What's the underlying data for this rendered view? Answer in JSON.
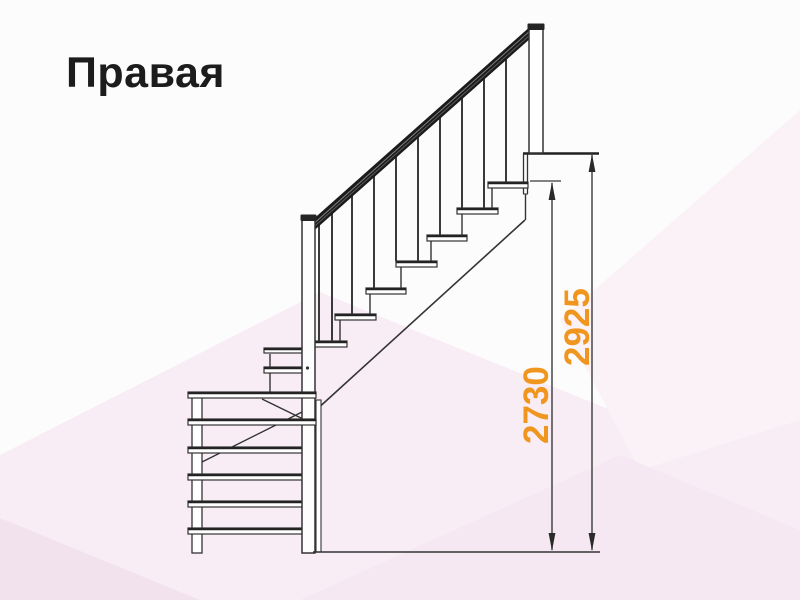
{
  "title": "Правая",
  "diagram": {
    "name": "staircase-right-turn-side-elevation",
    "dim_height_to_top_step": "2730",
    "dim_total_height": "2925",
    "colors": {
      "dimension_text": "#f0961f",
      "line": "#333333",
      "handrail": "#1b1b1b",
      "background_base": "#fdfcfd",
      "background_tint": "#f8edf5",
      "title_text": "#1c1c1c"
    },
    "counts": {
      "upper_flight_treads": 8,
      "lower_flight_treads": 6,
      "balusters": 10
    }
  }
}
